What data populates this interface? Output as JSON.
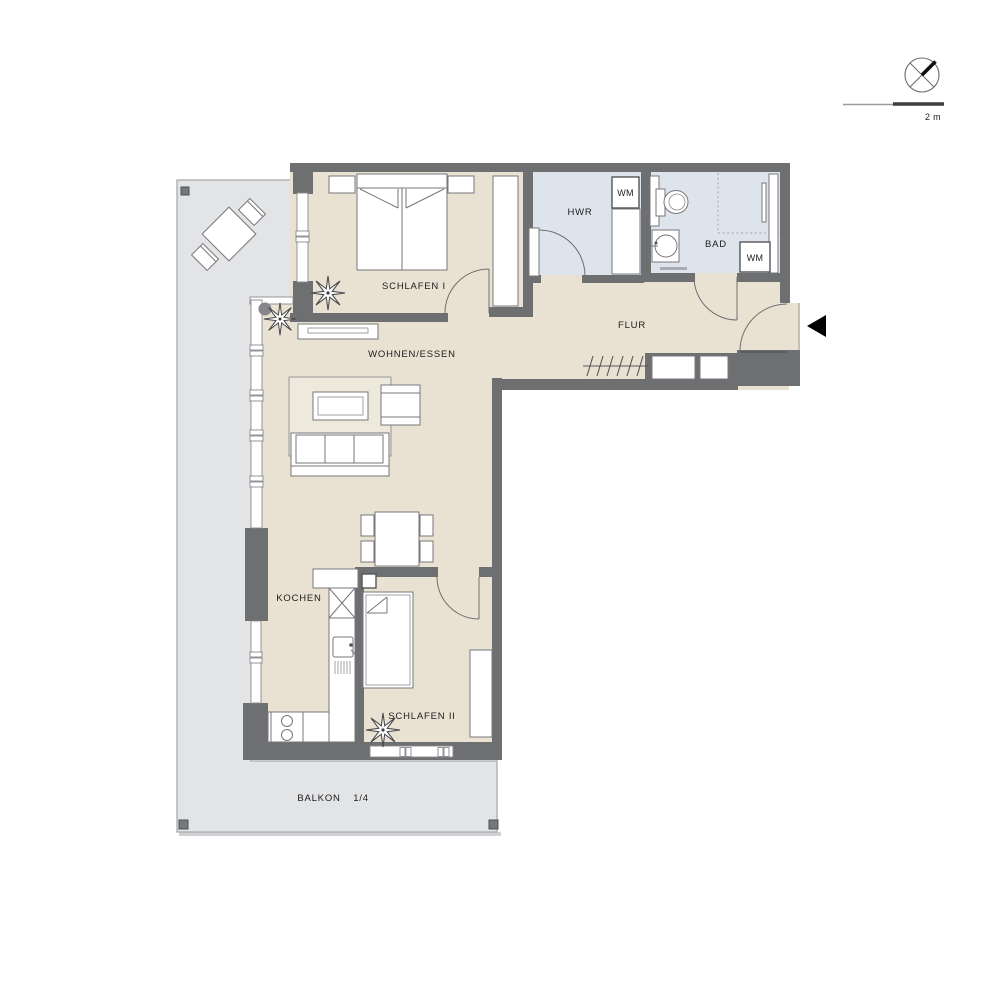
{
  "rooms": {
    "schlafen1": "SCHLAFEN I",
    "wohnen_essen": "WOHNEN/ESSEN",
    "flur": "FLUR",
    "hwr": "HWR",
    "bad": "BAD",
    "kochen": "KOCHEN",
    "schlafen2": "SCHLAFEN II"
  },
  "appliances": {
    "wm_hwr": "WM",
    "wm_bad": "WM"
  },
  "balcony": {
    "label": "BALKON",
    "share": "1/4"
  },
  "scale_bar": {
    "label": "2 m"
  },
  "icons": {
    "compass": "north-compass-icon",
    "entrance_arrow": "entrance-arrow-icon"
  },
  "colors": {
    "wall": "#6e6f71",
    "floor": "#e9e2d3",
    "wet_floor": "#dde4ec",
    "balcony": "#e3e4e6",
    "rug": "#eee9dd",
    "arrow": "#000000",
    "text": "#1c1c1c"
  }
}
